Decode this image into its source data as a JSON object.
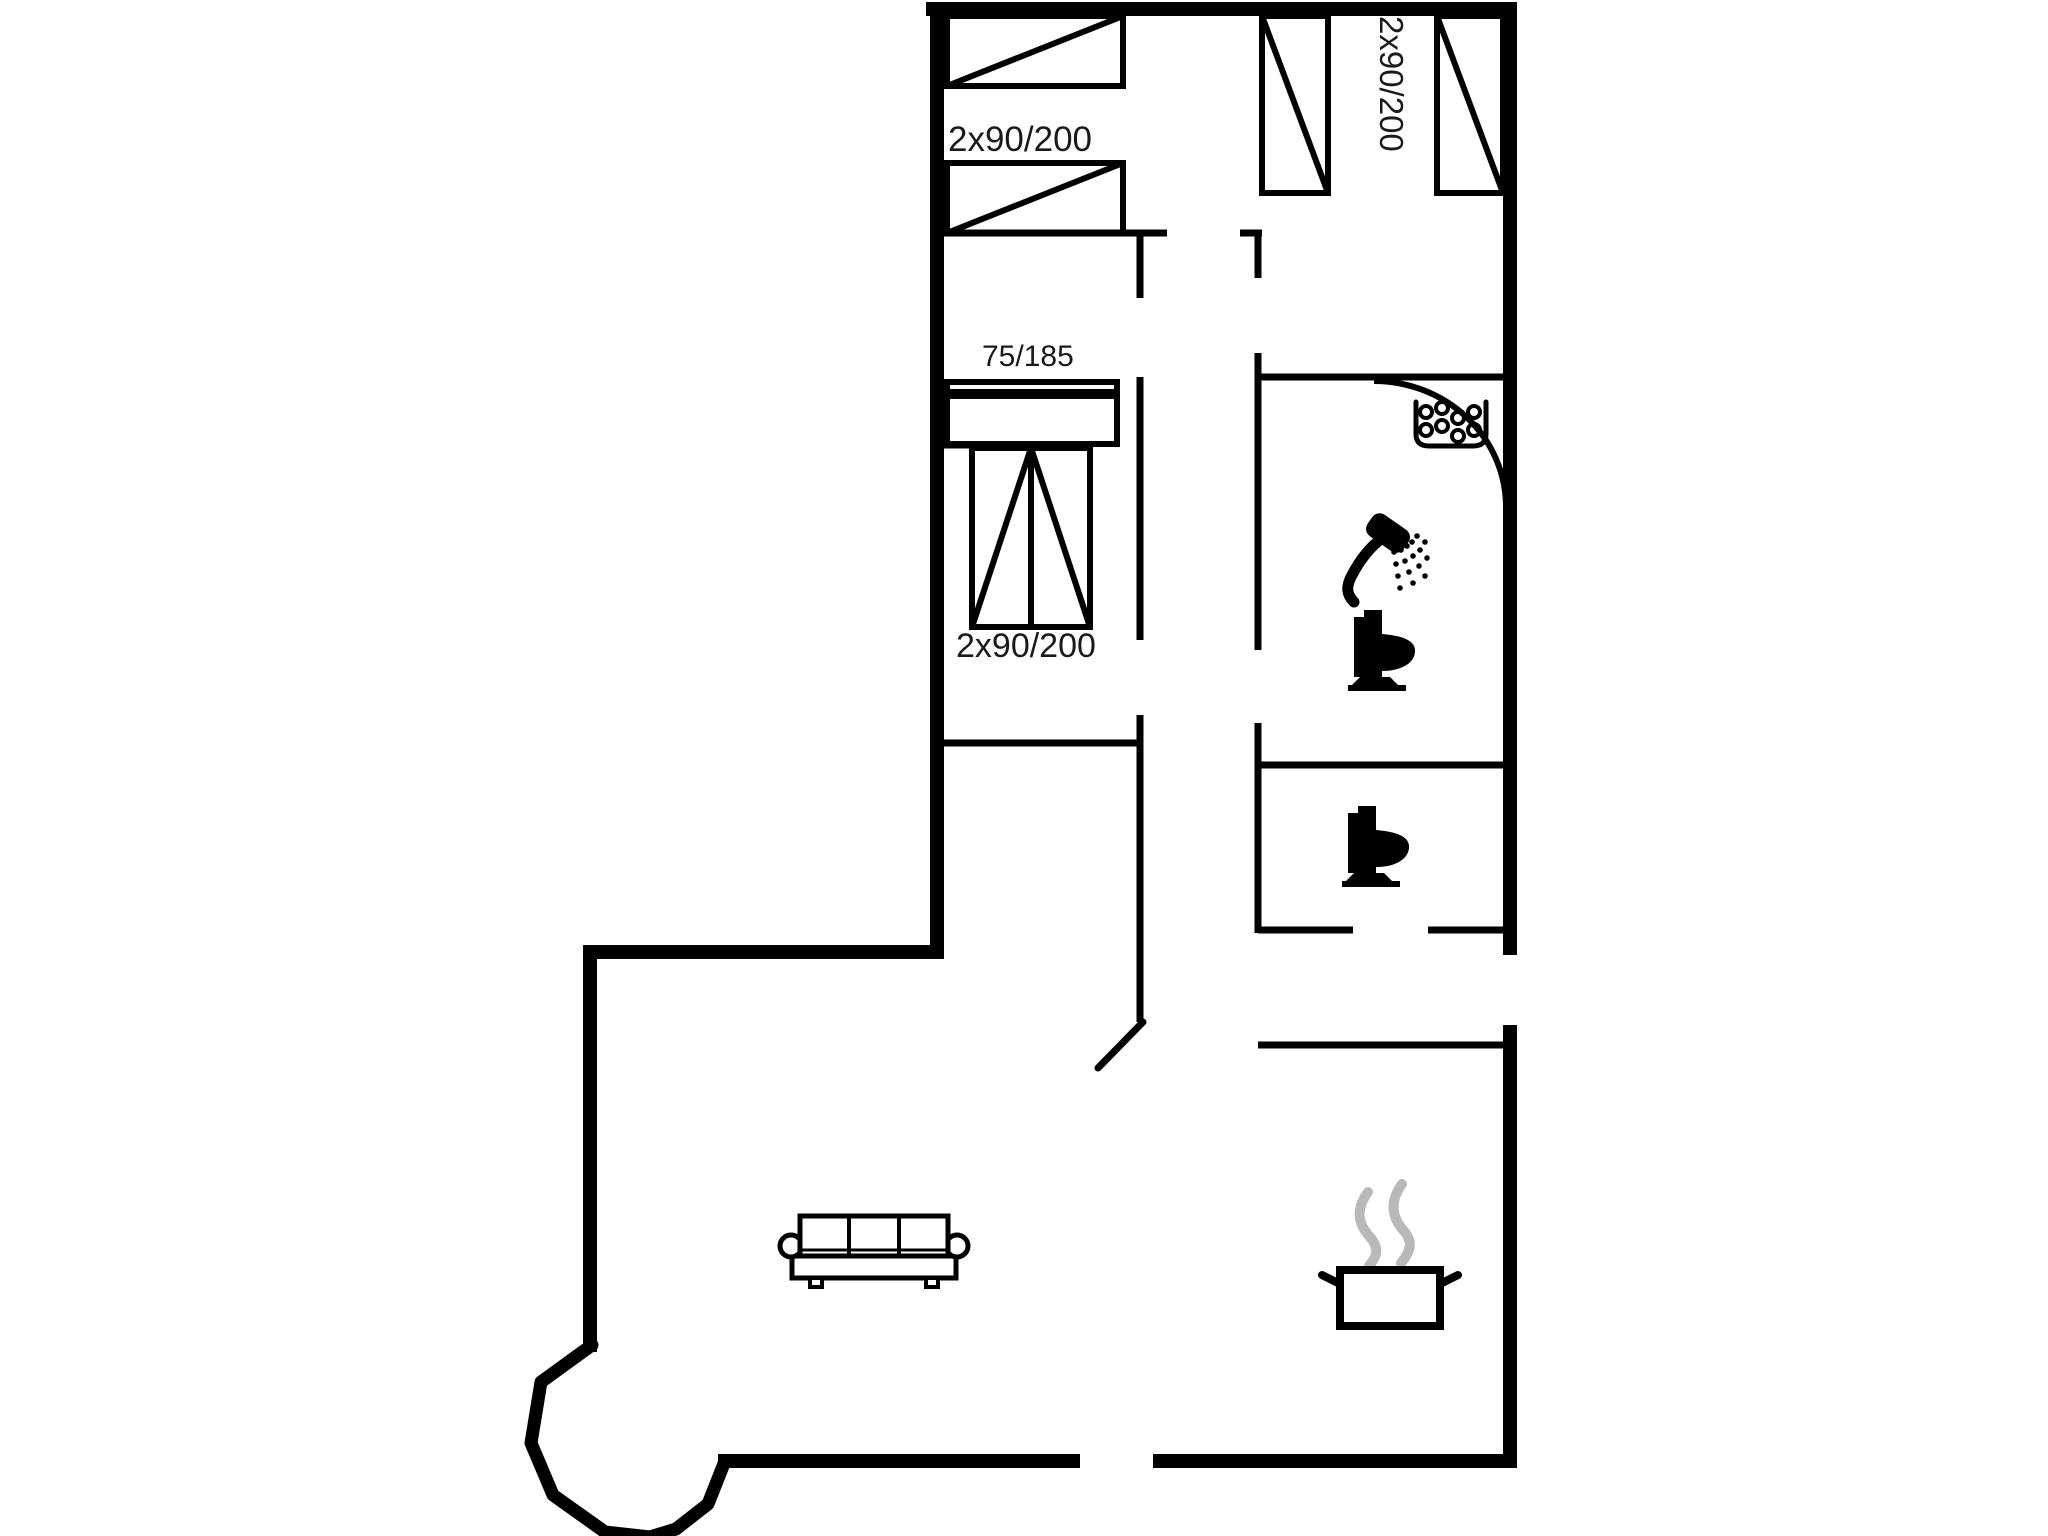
{
  "title": "holiday-house-floor-plan",
  "colors": {
    "wall": "#000000",
    "fixture": "#000000",
    "label": "#1a1a1a",
    "steam": "#b9b9b9",
    "background": "#ffffff"
  },
  "labels": {
    "top_left_bedroom": "2x90/200",
    "top_right_bedroom": "2x90/200",
    "middle_small_bed": "75/185",
    "middle_double_bed": "2x90/200"
  },
  "walls": {
    "thick_width": 14,
    "thin_width": 7,
    "thick": [
      [
        933,
        9,
        1510,
        9
      ],
      [
        937,
        9,
        937,
        950
      ],
      [
        1510,
        9,
        1510,
        948
      ],
      [
        1510,
        1032,
        1510,
        1458
      ],
      [
        590,
        952,
        937,
        952
      ],
      [
        590,
        952,
        590,
        1345
      ],
      [
        725,
        1461,
        1073,
        1461
      ],
      [
        1160,
        1461,
        1510,
        1461
      ]
    ],
    "thin": [
      [
        936,
        233,
        1167,
        233
      ],
      [
        1240,
        233,
        1262,
        233
      ],
      [
        1140,
        233,
        1140,
        298
      ],
      [
        1140,
        377,
        1140,
        640
      ],
      [
        1140,
        715,
        1140,
        1022
      ],
      [
        936,
        445,
        1093,
        445
      ],
      [
        936,
        743,
        1140,
        743
      ],
      [
        1258,
        233,
        1258,
        278
      ],
      [
        1258,
        353,
        1258,
        650
      ],
      [
        1258,
        377,
        1510,
        377
      ],
      [
        1258,
        723,
        1258,
        933
      ],
      [
        1258,
        765,
        1510,
        765
      ],
      [
        1258,
        930,
        1353,
        930
      ],
      [
        1428,
        930,
        1510,
        930
      ],
      [
        1258,
        1045,
        1510,
        1045
      ]
    ],
    "bay": [
      [
        592,
        1345
      ],
      [
        541,
        1382
      ],
      [
        531,
        1443
      ],
      [
        553,
        1495
      ],
      [
        605,
        1532
      ],
      [
        650,
        1537
      ],
      [
        676,
        1529
      ],
      [
        708,
        1504
      ],
      [
        725,
        1461
      ]
    ],
    "bay_width": 13
  },
  "doors": {
    "bathroom_arc_path": "M1374,381 A132,126 0 0 1 1506,505",
    "living_room_leaf": [
      1143,
      1022,
      1098,
      1068
    ]
  },
  "beds": [
    {
      "name": "bed-top-left-upper",
      "rect": [
        947,
        16,
        176,
        70
      ],
      "lines": [
        [
          947,
          86,
          1123,
          16
        ]
      ]
    },
    {
      "name": "bed-top-left-lower",
      "rect": [
        947,
        163,
        176,
        70
      ],
      "lines": [
        [
          947,
          233,
          1123,
          163
        ]
      ]
    },
    {
      "name": "bed-top-right-left",
      "rect": [
        1262,
        16,
        66,
        177
      ],
      "lines": [
        [
          1262,
          16,
          1328,
          193
        ]
      ]
    },
    {
      "name": "bed-top-right-right",
      "rect": [
        1437,
        16,
        66,
        177
      ],
      "lines": [
        [
          1437,
          16,
          1503,
          193
        ]
      ]
    },
    {
      "name": "bed-75x185",
      "rect": [
        947,
        382,
        170,
        62
      ],
      "lines": [
        [
          947,
          394,
          1117,
          394,
          10
        ]
      ]
    },
    {
      "name": "bed-double-vertical",
      "rect": [
        972,
        448,
        118,
        179
      ],
      "lines": [
        [
          1031,
          448,
          1031,
          627
        ],
        [
          972,
          627,
          1031,
          448
        ],
        [
          1090,
          627,
          1031,
          448
        ]
      ]
    }
  ],
  "icons": [
    {
      "name": "sofa-icon",
      "type": "sofa",
      "x": 778,
      "y": 1210
    },
    {
      "name": "washbasin-icon",
      "type": "basin",
      "x": 1412,
      "y": 398
    },
    {
      "name": "shower-icon",
      "type": "shower",
      "x": 1344,
      "y": 518
    },
    {
      "name": "toilet-icon",
      "type": "toilet",
      "x": 1344,
      "y": 610
    },
    {
      "name": "toilet-icon",
      "type": "toilet",
      "x": 1338,
      "y": 806
    },
    {
      "name": "cooking-pot-icon",
      "type": "pot",
      "x": 1322,
      "y": 1182
    }
  ]
}
